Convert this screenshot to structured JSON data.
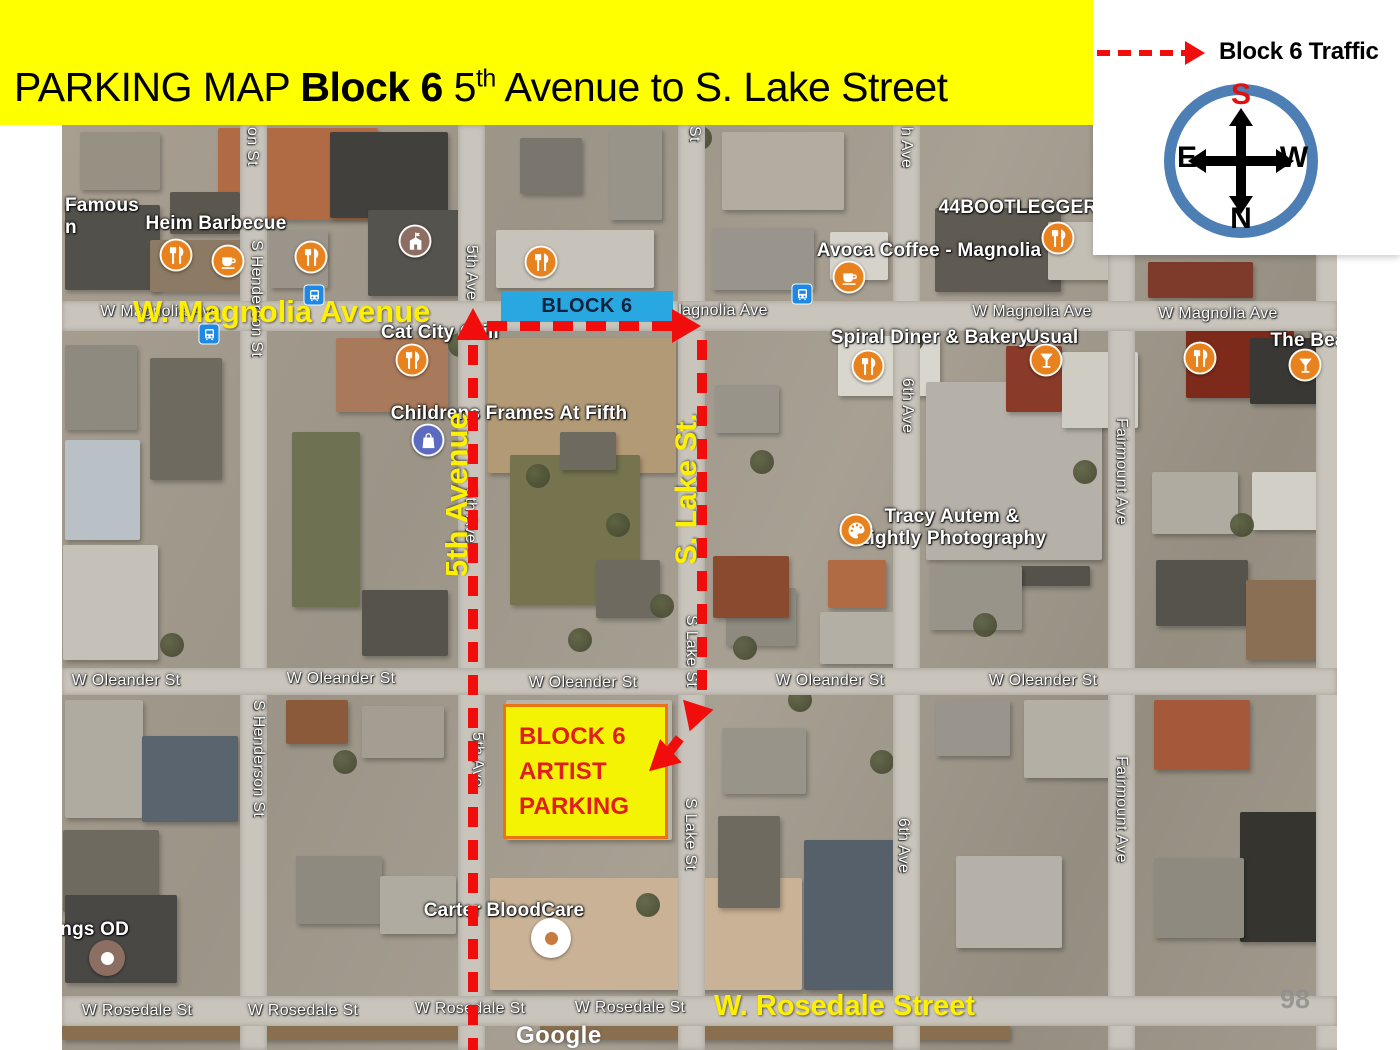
{
  "banner": {
    "title_regular": "PARKING MAP",
    "title_bold": "Block 6",
    "title_number": "5",
    "title_sup": "th",
    "title_rest": "Avenue to S. Lake Street"
  },
  "legend": {
    "label": "Block 6 Traffic"
  },
  "compass": {
    "top": "S",
    "bottom": "N",
    "left": "E",
    "right": "W"
  },
  "overlays": {
    "block6_badge": "BLOCK 6",
    "parking_lines": [
      "BLOCK 6",
      "ARTIST",
      "PARKING"
    ],
    "magnolia_avenue": "W. Magnolia Avenue",
    "fifth_avenue": "5th Avenue",
    "s_lake_st": "S. Lake St.",
    "rosedale_street": "W. Rosedale Street"
  },
  "map": {
    "watermark": "Google",
    "page_number": "98",
    "street_labels": [
      {
        "text": "W Magnolia Ave",
        "x": 160,
        "y": 303
      },
      {
        "text": "lagnolia Ave",
        "x": 723,
        "y": 302
      },
      {
        "text": "W Magnolia Ave",
        "x": 1032,
        "y": 303
      },
      {
        "text": "W Magnolia Ave",
        "x": 1218,
        "y": 305
      },
      {
        "text": "W Oleander St",
        "x": 126,
        "y": 672
      },
      {
        "text": "W Oleander St",
        "x": 341,
        "y": 670
      },
      {
        "text": "W Oleander St",
        "x": 583,
        "y": 674
      },
      {
        "text": "W Oleander St",
        "x": 830,
        "y": 672
      },
      {
        "text": "W Oleander St",
        "x": 1043,
        "y": 672
      },
      {
        "text": "W Rosedale St",
        "x": 137,
        "y": 1002
      },
      {
        "text": "W Rosedale St",
        "x": 303,
        "y": 1002
      },
      {
        "text": "W Rosedale St",
        "x": 470,
        "y": 1000
      },
      {
        "text": "W Rosedale St",
        "x": 630,
        "y": 999
      },
      {
        "text": "on St",
        "x": 252,
        "y": 127,
        "vertical": true
      },
      {
        "text": "S Henderson St",
        "x": 256,
        "y": 240,
        "vertical": true
      },
      {
        "text": "S Henderson St",
        "x": 258,
        "y": 700,
        "vertical": true
      },
      {
        "text": "5th Ave",
        "x": 471,
        "y": 245,
        "vertical": true
      },
      {
        "text": "5th Ave",
        "x": 470,
        "y": 488,
        "vertical": true
      },
      {
        "text": "5th Ave",
        "x": 477,
        "y": 732,
        "vertical": true
      },
      {
        "text": "St",
        "x": 694,
        "y": 126,
        "vertical": true
      },
      {
        "text": "S Lake St",
        "x": 691,
        "y": 615,
        "vertical": true
      },
      {
        "text": "S Lake St",
        "x": 690,
        "y": 798,
        "vertical": true
      },
      {
        "text": "h Ave",
        "x": 906,
        "y": 127,
        "vertical": true
      },
      {
        "text": "6th Ave",
        "x": 907,
        "y": 378,
        "vertical": true
      },
      {
        "text": "6th Ave",
        "x": 903,
        "y": 818,
        "vertical": true
      },
      {
        "text": "Fairmount Ave",
        "x": 1121,
        "y": 418,
        "vertical": true
      },
      {
        "text": "Fairmount Ave",
        "x": 1121,
        "y": 756,
        "vertical": true
      },
      {
        "text": "7th Ave",
        "x": 1332,
        "y": 95,
        "vertical": true
      }
    ],
    "poi_labels": [
      {
        "lines": [
          "Famous",
          "n"
        ],
        "x": 65,
        "y": 195,
        "left": true
      },
      {
        "lines": [
          "Heim Barbecue"
        ],
        "x": 216,
        "y": 213
      },
      {
        "lines": [
          "Cat City Grill"
        ],
        "x": 440,
        "y": 322
      },
      {
        "lines": [
          "Childrens Frames At Fifth"
        ],
        "x": 509,
        "y": 403
      },
      {
        "lines": [
          "Avoca Coffee - Magnolia"
        ],
        "x": 929,
        "y": 240
      },
      {
        "lines": [
          "44BOOTLEGGER"
        ],
        "x": 1018,
        "y": 197
      },
      {
        "lines": [
          "Spiral Diner & Bakery"
        ],
        "x": 930,
        "y": 327
      },
      {
        "lines": [
          "Usual"
        ],
        "x": 1052,
        "y": 327
      },
      {
        "lines": [
          "The Bea"
        ],
        "x": 1308,
        "y": 330
      },
      {
        "lines": [
          "Tracy Autem &",
          "Lightly Photography"
        ],
        "x": 952,
        "y": 506
      },
      {
        "lines": [
          "Carter BloodCare"
        ],
        "x": 504,
        "y": 900
      },
      {
        "lines": [
          "hings OD"
        ],
        "x": 43,
        "y": 919,
        "left": true
      }
    ],
    "poi_icons": [
      {
        "type": "restaurant",
        "x": 176,
        "y": 255
      },
      {
        "type": "coffee",
        "x": 228,
        "y": 261
      },
      {
        "type": "restaurant",
        "x": 311,
        "y": 257
      },
      {
        "type": "school",
        "x": 415,
        "y": 241
      },
      {
        "type": "restaurant",
        "x": 541,
        "y": 262
      },
      {
        "type": "restaurant",
        "x": 412,
        "y": 360
      },
      {
        "type": "coffee",
        "x": 849,
        "y": 277
      },
      {
        "type": "restaurant",
        "x": 1058,
        "y": 238
      },
      {
        "type": "restaurant",
        "x": 868,
        "y": 366
      },
      {
        "type": "martini",
        "x": 1046,
        "y": 360
      },
      {
        "type": "palette",
        "x": 856,
        "y": 530
      },
      {
        "type": "shopping",
        "x": 428,
        "y": 440
      },
      {
        "type": "restaurant",
        "x": 1200,
        "y": 358
      },
      {
        "type": "martini",
        "x": 1305,
        "y": 365
      },
      {
        "type": "blood",
        "x": 551,
        "y": 938
      },
      {
        "type": "optometry",
        "x": 107,
        "y": 958
      }
    ],
    "bus_stops": [
      {
        "x": 314,
        "y": 295
      },
      {
        "x": 209,
        "y": 334
      },
      {
        "x": 802,
        "y": 294
      }
    ]
  },
  "colors": {
    "banner_bg": "#FFFF00",
    "route_red": "#F20D0D",
    "badge_bg": "#29A7E0",
    "badge_text": "#0F2440",
    "parking_fill": "#F3F303",
    "parking_border": "#E87511",
    "parking_text": "#E01E1E",
    "overlay_yellow": "#FFF000",
    "compass_ring": "#4D7EB4",
    "compass_south": "#E01010",
    "poi_orange": "#E8821E",
    "poi_school_brown": "#8D6E63",
    "poi_shopping_blue": "#5C6BC0",
    "bus_blue": "#1E88E5"
  }
}
